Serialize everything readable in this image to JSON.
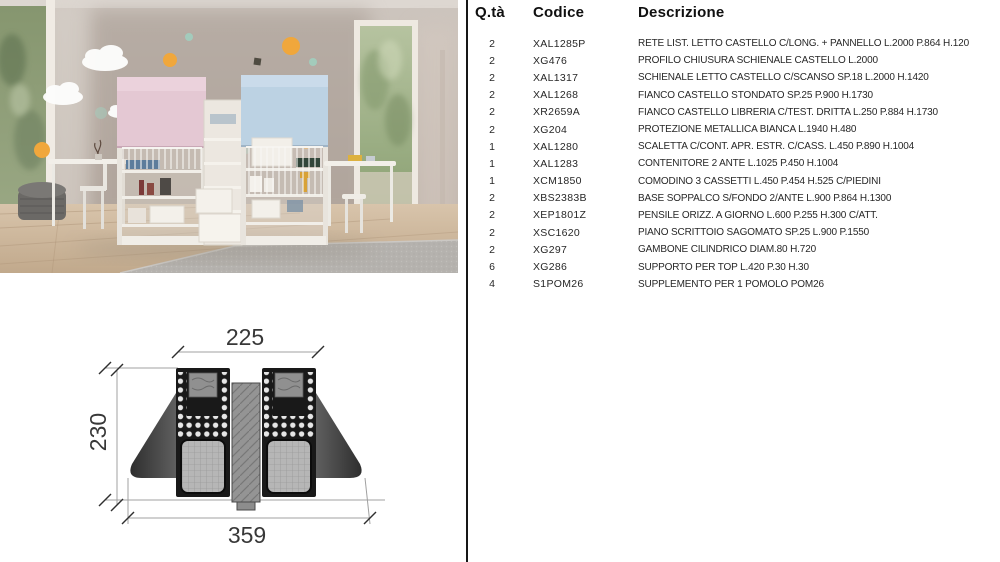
{
  "colors": {
    "divider": "#161616",
    "text": "#272727",
    "bed_panel_pink": "#e4c8d3",
    "bed_panel_blue": "#bcd2e3",
    "decal_orange": "#f0a73c",
    "decal_mint": "#9fd3c2",
    "wall": "#b7aba3",
    "floor_wood": "#c8b299",
    "rug_gray": "#b5b2ae"
  },
  "drawing": {
    "dim_top": "225",
    "dim_left": "230",
    "dim_bottom": "359"
  },
  "table": {
    "headers": {
      "qty": "Q.tà",
      "code": "Codice",
      "desc": "Descrizione"
    },
    "rows": [
      {
        "qty": "2",
        "code": "XAL1285P",
        "desc": "RETE LIST. LETTO CASTELLO C/LONG. + PANNELLO L.2000 P.864 H.120"
      },
      {
        "qty": "2",
        "code": "XG476",
        "desc": "PROFILO CHIUSURA SCHIENALE CASTELLO L.2000"
      },
      {
        "qty": "2",
        "code": "XAL1317",
        "desc": "SCHIENALE LETTO CASTELLO C/SCANSO SP.18 L.2000 H.1420"
      },
      {
        "qty": "2",
        "code": "XAL1268",
        "desc": "FIANCO CASTELLO STONDATO SP.25 P.900 H.1730"
      },
      {
        "qty": "2",
        "code": "XR2659A",
        "desc": "FIANCO CASTELLO LIBRERIA C/TEST. DRITTA L.250 P.884 H.1730"
      },
      {
        "qty": "2",
        "code": "XG204",
        "desc": "PROTEZIONE METALLICA BIANCA L.1940 H.480"
      },
      {
        "qty": "1",
        "code": "XAL1280",
        "desc": "SCALETTA C/CONT. APR. ESTR. C/CASS. L.450 P.890 H.1004"
      },
      {
        "qty": "1",
        "code": "XAL1283",
        "desc": "CONTENITORE 2 ANTE L.1025 P.450 H.1004"
      },
      {
        "qty": "1",
        "code": "XCM1850",
        "desc": "COMODINO 3 CASSETTI L.450 P.454 H.525 C/PIEDINI"
      },
      {
        "qty": "2",
        "code": "XBS2383B",
        "desc": "BASE SOPPALCO S/FONDO 2/ANTE L.900 P.864 H.1300"
      },
      {
        "qty": "2",
        "code": "XEP1801Z",
        "desc": "PENSILE ORIZZ. A GIORNO L.600 P.255 H.300 C/ATT."
      },
      {
        "qty": "2",
        "code": "XSC1620",
        "desc": "PIANO SCRITTOIO SAGOMATO SP.25 L.900 P.1550"
      },
      {
        "qty": "2",
        "code": "XG297",
        "desc": "GAMBONE CILINDRICO DIAM.80 H.720"
      },
      {
        "qty": "6",
        "code": "XG286",
        "desc": "SUPPORTO PER TOP L.420 P.30 H.30"
      },
      {
        "qty": "4",
        "code": "S1POM26",
        "desc": "SUPPLEMENTO PER 1 POMOLO POM26"
      }
    ]
  }
}
